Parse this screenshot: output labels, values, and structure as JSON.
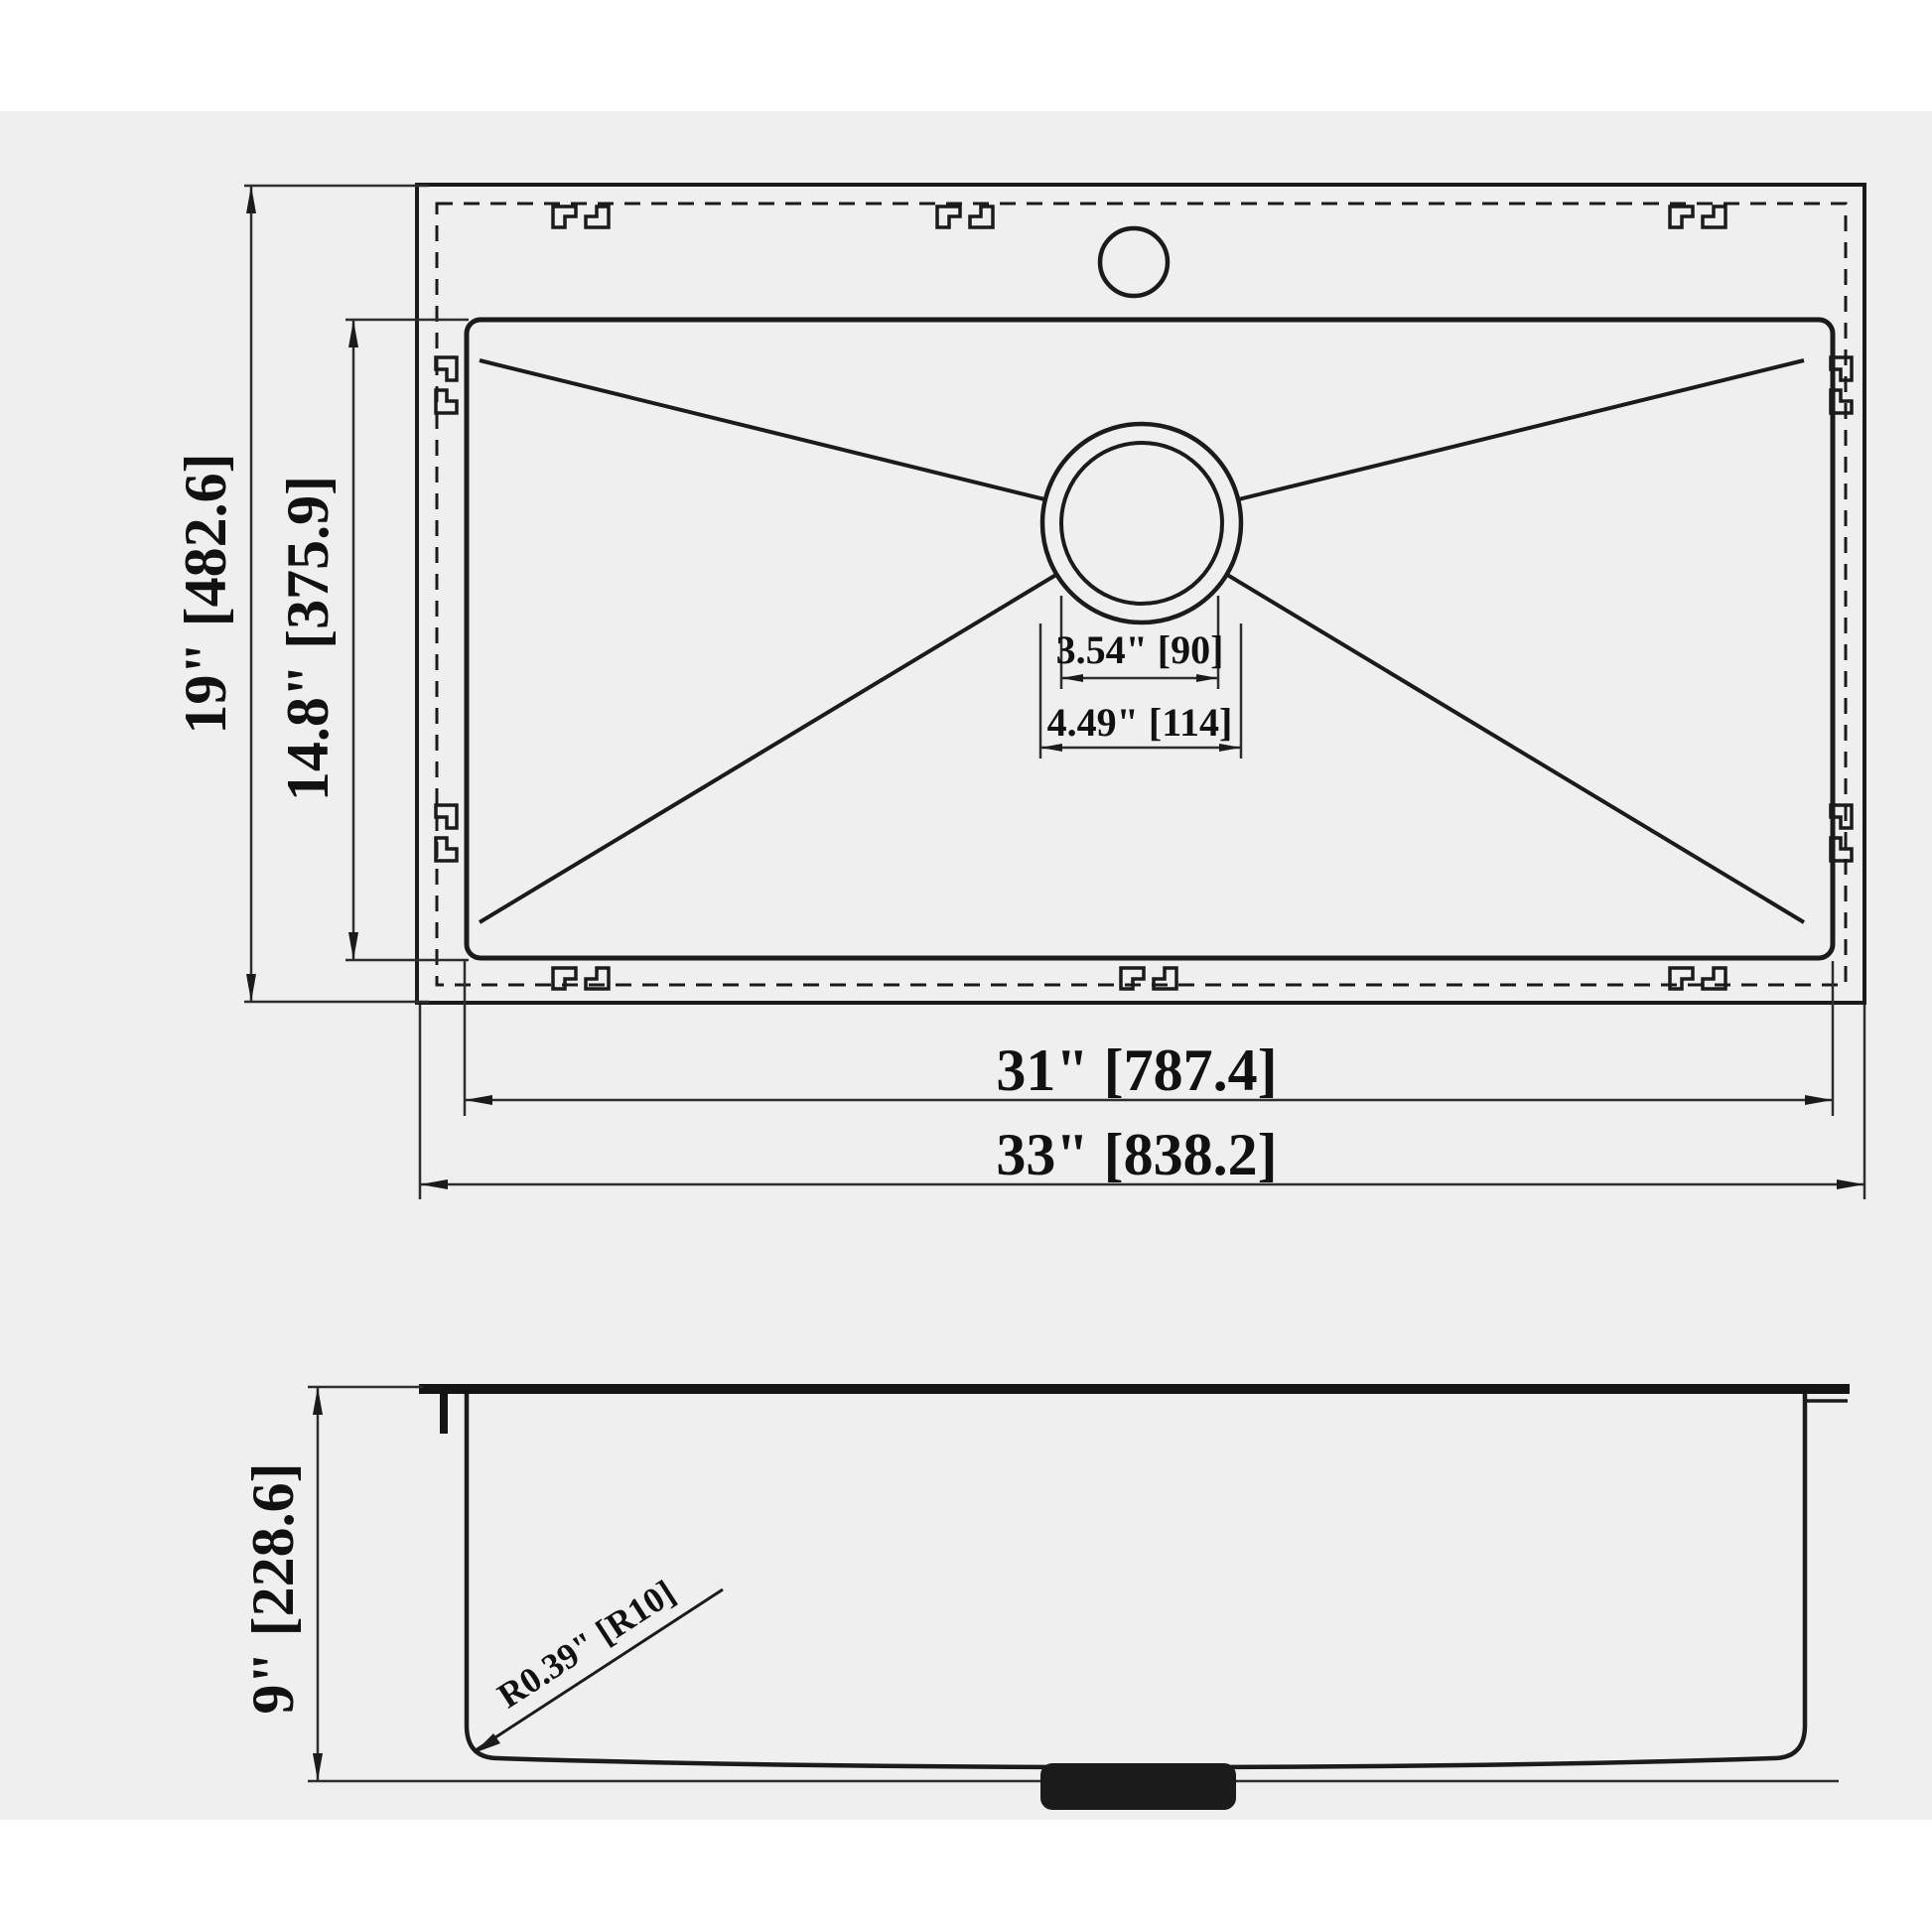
{
  "drawing": {
    "title": "sink-technical-drawing",
    "colors": {
      "page_bg": "#ffffff",
      "panel_bg": "#efefef",
      "line": "#1b1b1b"
    },
    "top_view": {
      "overall_height_label": "19\" [482.6]",
      "bowl_height_label": "14.8\" [375.9]",
      "bowl_width_label": "31\" [787.4]",
      "overall_width_label": "33\" [838.2]",
      "drain_inner_label": "3.54\" [90]",
      "drain_outer_label": "4.49\" [114]"
    },
    "side_view": {
      "depth_label": "9\" [228.6]",
      "corner_radius_label": "R0.39\" [R10]"
    }
  }
}
